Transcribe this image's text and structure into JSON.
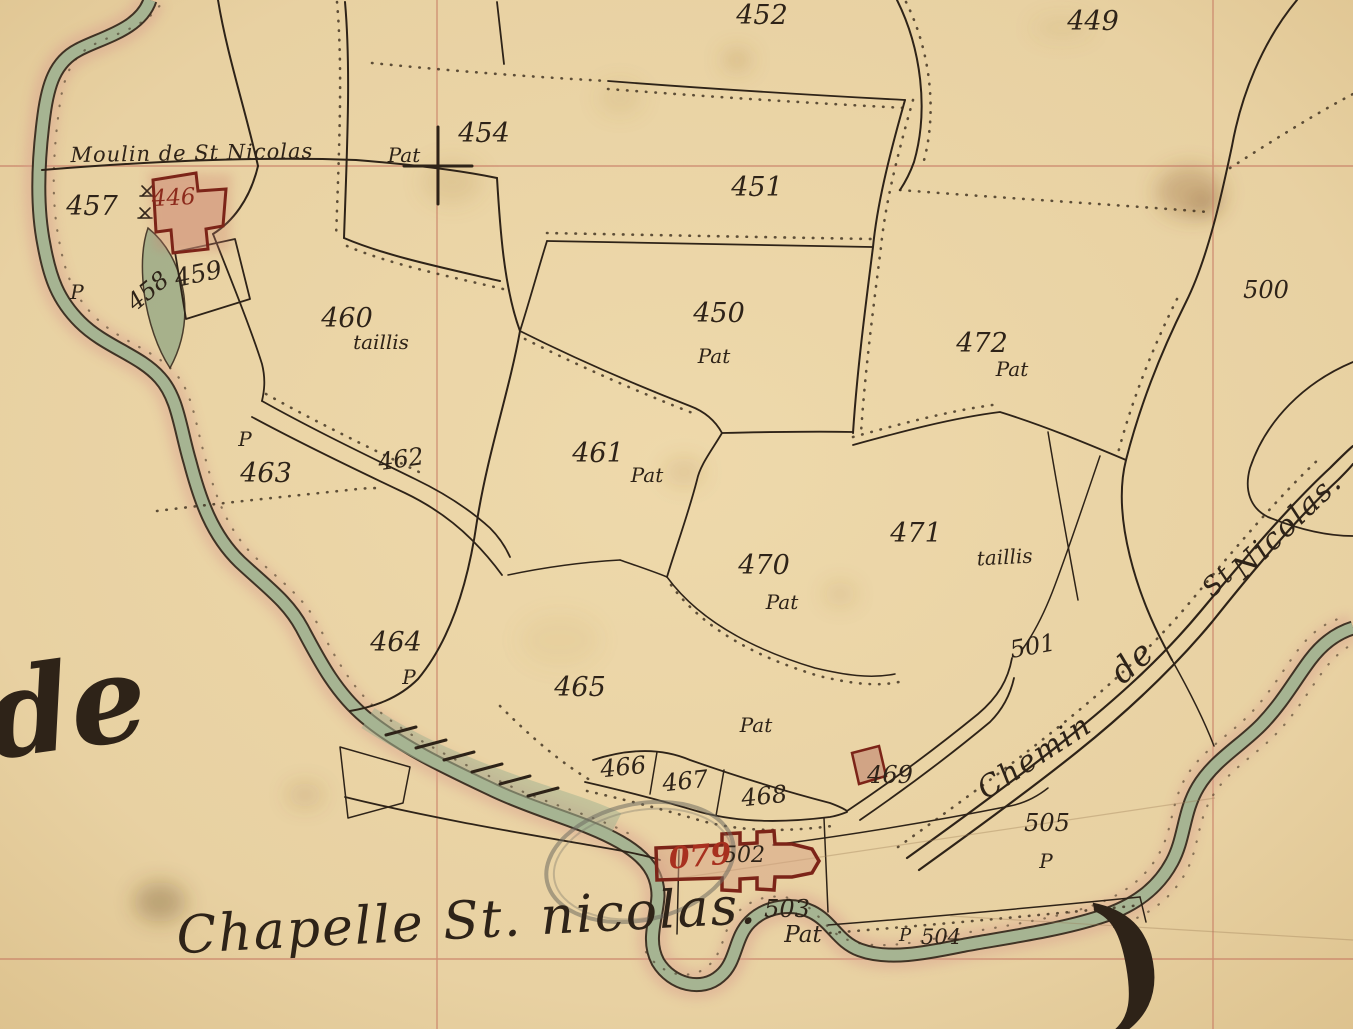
{
  "map": {
    "type": "scanned historical cadastral map",
    "place_names": {
      "moulin": "Moulin de St Nicolas",
      "chapelle": "Chapelle St. nicolas.",
      "chemin": [
        "Chemin",
        "de",
        "St",
        "Nicolas."
      ],
      "margin_script_left": "de",
      "margin_script_right": ")"
    },
    "annotations": {
      "red_overlay_number": "079"
    },
    "parcel_numbers": [
      "446",
      "449",
      "450",
      "451",
      "452",
      "454",
      "457",
      "458",
      "459",
      "460",
      "461",
      "462",
      "463",
      "464",
      "465",
      "466",
      "467",
      "468",
      "469",
      "470",
      "471",
      "472",
      "500",
      "501",
      "502",
      "503",
      "504",
      "505"
    ],
    "land_use_notes": [
      "Pat",
      "taillis",
      "P"
    ],
    "colors": {
      "paper": "#e8d1a2",
      "ink": "#2e2318",
      "grid_red": "#c4705c",
      "stream_green": "#a6b492",
      "fringe_pink": "#d99e8e",
      "building_red": "#7c2418",
      "annotation_red": "#a8301f",
      "pencil_grey": "#6f6c62"
    }
  },
  "labels": [
    {
      "text": "452",
      "x": 762,
      "y": 24,
      "cls": "lbl-number",
      "name": "parcel-452-label"
    },
    {
      "text": "449",
      "x": 1093,
      "y": 30,
      "cls": "lbl-number",
      "name": "parcel-449-label"
    },
    {
      "text": "454",
      "x": 484,
      "y": 142,
      "cls": "lbl-number",
      "name": "parcel-454-label"
    },
    {
      "text": "Pat",
      "x": 404,
      "y": 162,
      "cls": "lbl-sub",
      "name": "landuse-454"
    },
    {
      "text": "451",
      "x": 757,
      "y": 196,
      "cls": "lbl-number",
      "name": "parcel-451-label"
    },
    {
      "text": "457",
      "x": 92,
      "y": 215,
      "cls": "lbl-number",
      "name": "parcel-457-label"
    },
    {
      "text": "P",
      "x": 77,
      "y": 299,
      "cls": "lbl-sub",
      "name": "landuse-457"
    },
    {
      "text": "446",
      "x": 174,
      "y": 205,
      "rot": -3,
      "size": 23,
      "fill": "#8c2a1c",
      "cls": "lbl-number",
      "name": "parcel-446-label"
    },
    {
      "text": "459",
      "x": 200,
      "y": 282,
      "rot": -12,
      "size": 25,
      "cls": "lbl-number",
      "name": "parcel-459-label"
    },
    {
      "text": "458",
      "x": 153,
      "y": 297,
      "rot": -40,
      "size": 24,
      "cls": "lbl-number",
      "name": "parcel-458-label"
    },
    {
      "text": "500",
      "x": 1266,
      "y": 298,
      "size": 24,
      "cls": "lbl-number",
      "name": "parcel-500-label"
    },
    {
      "text": "460",
      "x": 347,
      "y": 327,
      "cls": "lbl-number",
      "name": "parcel-460-label"
    },
    {
      "text": "taillis",
      "x": 381,
      "y": 349,
      "cls": "lbl-sub",
      "name": "landuse-460"
    },
    {
      "text": "450",
      "x": 719,
      "y": 322,
      "cls": "lbl-number",
      "name": "parcel-450-label"
    },
    {
      "text": "Pat",
      "x": 714,
      "y": 363,
      "cls": "lbl-sub",
      "name": "landuse-450"
    },
    {
      "text": "472",
      "x": 982,
      "y": 352,
      "cls": "lbl-number",
      "name": "parcel-472-label"
    },
    {
      "text": "Pat",
      "x": 1012,
      "y": 376,
      "cls": "lbl-sub",
      "name": "landuse-472"
    },
    {
      "text": "463",
      "x": 266,
      "y": 482,
      "cls": "lbl-number",
      "name": "parcel-463-label"
    },
    {
      "text": "P",
      "x": 245,
      "y": 446,
      "cls": "lbl-sub",
      "name": "landuse-463"
    },
    {
      "text": "462",
      "x": 402,
      "y": 467,
      "rot": -8,
      "size": 24,
      "cls": "lbl-number",
      "name": "parcel-462-label"
    },
    {
      "text": "461",
      "x": 598,
      "y": 462,
      "cls": "lbl-number",
      "name": "parcel-461-label"
    },
    {
      "text": "Pat",
      "x": 647,
      "y": 482,
      "cls": "lbl-sub",
      "name": "landuse-461"
    },
    {
      "text": "471",
      "x": 916,
      "y": 542,
      "cls": "lbl-number",
      "name": "parcel-471-label"
    },
    {
      "text": "taillis",
      "x": 1005,
      "y": 564,
      "rot": -3,
      "cls": "lbl-sub",
      "name": "landuse-471"
    },
    {
      "text": "470",
      "x": 764,
      "y": 574,
      "cls": "lbl-number",
      "name": "parcel-470-label"
    },
    {
      "text": "Pat",
      "x": 782,
      "y": 609,
      "cls": "lbl-sub",
      "name": "landuse-470"
    },
    {
      "text": "501",
      "x": 1034,
      "y": 654,
      "rot": -10,
      "size": 24,
      "cls": "lbl-number",
      "name": "parcel-501-label"
    },
    {
      "text": "464",
      "x": 396,
      "y": 651,
      "cls": "lbl-number",
      "name": "parcel-464-label"
    },
    {
      "text": "P",
      "x": 409,
      "y": 684,
      "cls": "lbl-sub",
      "name": "landuse-464"
    },
    {
      "text": "465",
      "x": 580,
      "y": 696,
      "cls": "lbl-number",
      "name": "parcel-465-label"
    },
    {
      "text": "Pat",
      "x": 756,
      "y": 732,
      "cls": "lbl-sub",
      "name": "landuse-465"
    },
    {
      "text": "466",
      "x": 624,
      "y": 775,
      "rot": -6,
      "size": 24,
      "cls": "lbl-number",
      "name": "parcel-466-label"
    },
    {
      "text": "467",
      "x": 686,
      "y": 789,
      "rot": -6,
      "size": 24,
      "cls": "lbl-number",
      "name": "parcel-467-label"
    },
    {
      "text": "468",
      "x": 765,
      "y": 804,
      "rot": -6,
      "size": 24,
      "cls": "lbl-number",
      "name": "parcel-468-label"
    },
    {
      "text": "469",
      "x": 890,
      "y": 783,
      "size": 24,
      "cls": "lbl-number",
      "name": "parcel-469-label"
    },
    {
      "text": "505",
      "x": 1047,
      "y": 831,
      "size": 24,
      "cls": "lbl-number",
      "name": "parcel-505-label"
    },
    {
      "text": "P",
      "x": 1046,
      "y": 868,
      "cls": "lbl-sub",
      "name": "landuse-505"
    },
    {
      "text": "502",
      "x": 744,
      "y": 862,
      "size": 22,
      "cls": "lbl-number",
      "name": "parcel-502-label"
    },
    {
      "text": "079",
      "x": 701,
      "y": 866,
      "rot": -5,
      "cls": "lbl-red",
      "name": "red-annotation-079"
    },
    {
      "text": "503",
      "x": 787,
      "y": 917,
      "size": 24,
      "cls": "lbl-number",
      "name": "parcel-503-label"
    },
    {
      "text": "Pat",
      "x": 803,
      "y": 942,
      "size": 23,
      "cls": "lbl-sub",
      "name": "landuse-503"
    },
    {
      "text": "P",
      "x": 905,
      "y": 941,
      "size": 18,
      "cls": "lbl-sub",
      "name": "landuse-504-p"
    },
    {
      "text": "504",
      "x": 941,
      "y": 944,
      "size": 21,
      "cls": "lbl-number",
      "name": "parcel-504-label"
    },
    {
      "text": "Moulin de St Nicolas",
      "x": 192,
      "y": 160,
      "rot": -1,
      "cls": "lbl-moulin",
      "name": "moulin-name"
    },
    {
      "text": "Chapelle St. nicolas.",
      "x": 468,
      "y": 938,
      "rot": -3,
      "cls": "lbl-chapelle",
      "name": "chapelle-name"
    },
    {
      "text": "Chemin",
      "x": 1040,
      "y": 765,
      "rot": -33,
      "cls": "lbl-chemin",
      "name": "chemin-word-1"
    },
    {
      "text": "de",
      "x": 1140,
      "y": 670,
      "rot": -42,
      "size": 34,
      "cls": "lbl-chemin",
      "name": "chemin-word-2"
    },
    {
      "text": "St",
      "x": 1224,
      "y": 587,
      "rot": -45,
      "size": 26,
      "cls": "lbl-chemin",
      "name": "chemin-word-3"
    },
    {
      "text": "Nicolas.",
      "x": 1294,
      "y": 532,
      "rot": -44,
      "cls": "lbl-chemin",
      "name": "chemin-word-4"
    },
    {
      "text": "de",
      "x": 72,
      "y": 748,
      "rot": -8,
      "cls": "lbl-margin",
      "name": "margin-script-de"
    },
    {
      "text": ")",
      "x": 1140,
      "y": 1010,
      "rot": -10,
      "cls": "lbl-paren",
      "name": "margin-script-paren"
    }
  ]
}
